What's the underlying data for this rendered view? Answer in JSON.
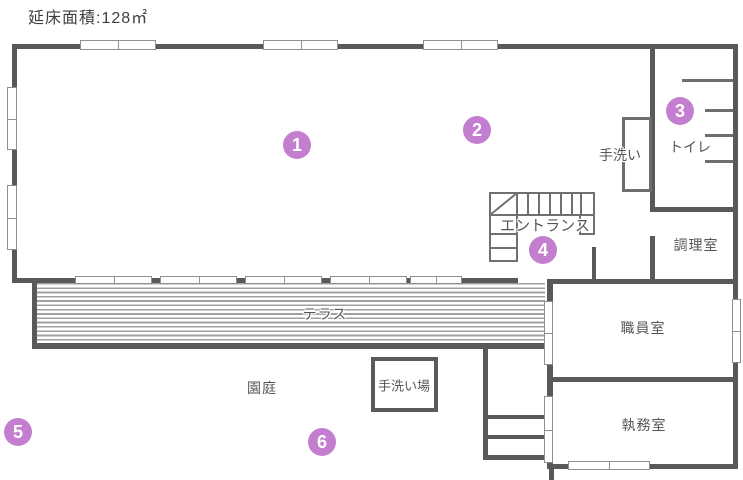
{
  "title": "延床面積:128㎡",
  "plan": {
    "labels": {
      "terrace": "テラス",
      "yard": "園庭",
      "hand_wash_station": "手洗い場",
      "entrance": "エントランス",
      "hand_wash": "手洗い",
      "toilet": "トイレ",
      "kitchen": "調理室",
      "staff_room": "職員室",
      "office": "執務室"
    },
    "markers": [
      "1",
      "2",
      "3",
      "4",
      "5",
      "6"
    ],
    "colors": {
      "wall": "#595959",
      "marker_fill": "#c47ed0",
      "marker_text": "#ffffff",
      "label_text": "#565656"
    }
  }
}
